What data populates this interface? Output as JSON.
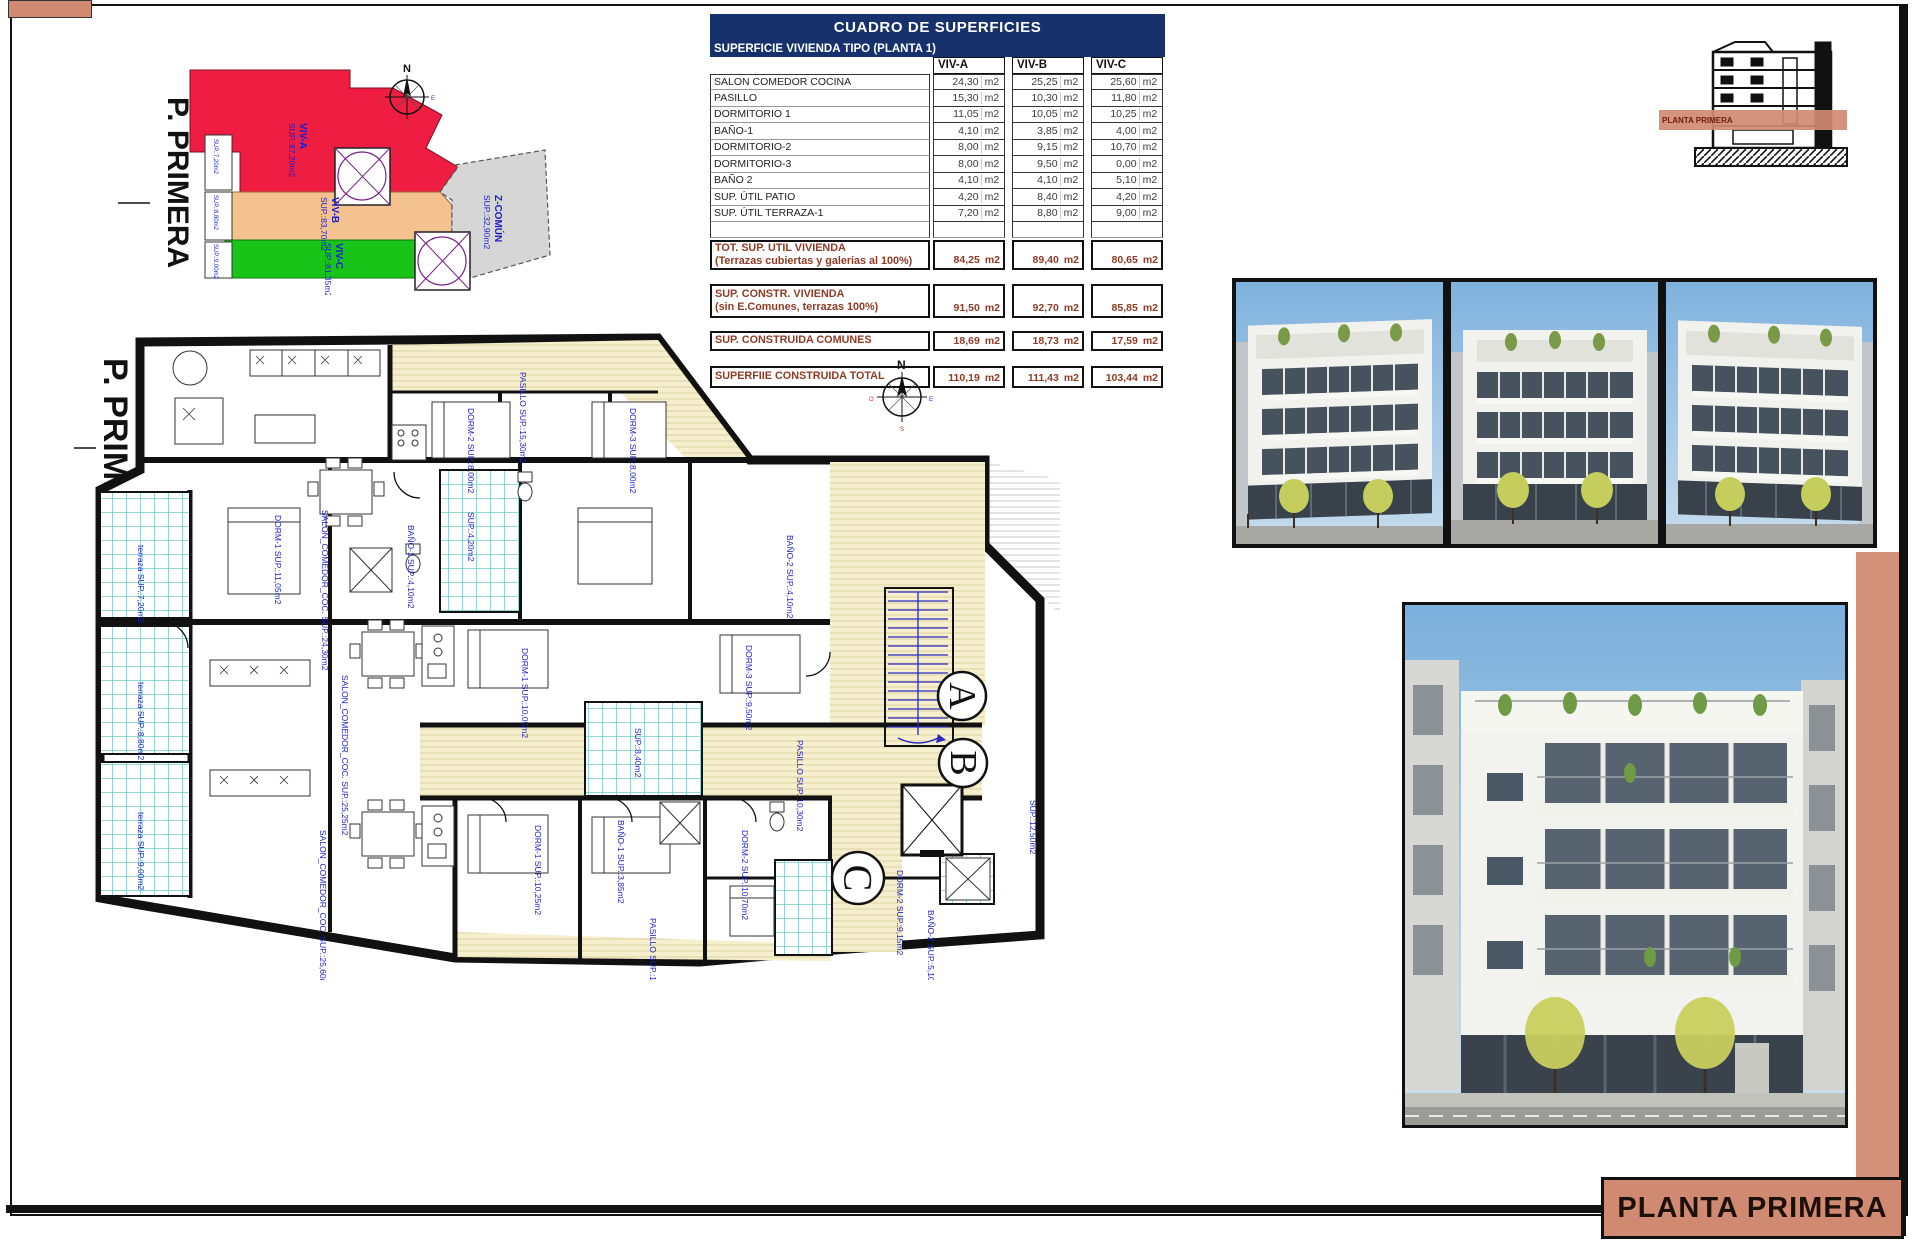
{
  "sheet": {
    "title_block": "PLANTA PRIMERA"
  },
  "colors": {
    "accent_salmon": "#d08a72",
    "navy_header": "#16316b",
    "viv_a_red": "#ee1d41",
    "viv_b_orange": "#f4c28f",
    "viv_c_green": "#17c417",
    "common_gray": "#d6d6d6",
    "label_blue": "#1c1ccf",
    "summary_brown": "#8e3b25"
  },
  "table": {
    "title": "CUADRO DE SUPERFICIES",
    "subtitle": "SUPERFICIE VIVIENDA TIPO  (PLANTA 1)",
    "columns": [
      "VIV-A",
      "VIV-B",
      "VIV-C"
    ],
    "unit": "m2",
    "rows": [
      {
        "label": "SALON COMEDOR COCINA",
        "a": "24,30",
        "b": "25,25",
        "c": "25,60"
      },
      {
        "label": "PASILLO",
        "a": "15,30",
        "b": "10,30",
        "c": "11,80"
      },
      {
        "label": "DORMITORIO 1",
        "a": "11,05",
        "b": "10,05",
        "c": "10,25"
      },
      {
        "label": "BAÑO-1",
        "a": "4,10",
        "b": "3,85",
        "c": "4,00"
      },
      {
        "label": "DORMITORIO-2",
        "a": "8,00",
        "b": "9,15",
        "c": "10,70"
      },
      {
        "label": "DORMITORIO-3",
        "a": "8,00",
        "b": "9,50",
        "c": "0,00"
      },
      {
        "label": "BAÑO 2",
        "a": "4,10",
        "b": "4,10",
        "c": "5,10"
      },
      {
        "label": "SUP. ÚTIL PATIO",
        "a": "4,20",
        "b": "8,40",
        "c": "4,20"
      },
      {
        "label": "SUP. ÚTIL TERRAZA-1",
        "a": "7,20",
        "b": "8,80",
        "c": "9,00"
      }
    ],
    "summary": [
      {
        "label1": "TOT. SUP. UTIL VIVIENDA",
        "label2": "(Terrazas cubiertas y galerias al 100%)",
        "a": "84,25",
        "b": "89,40",
        "c": "80,65"
      },
      {
        "label1": "SUP. CONSTR. VIVIENDA",
        "label2": "(sin E.Comunes, terrazas 100%)",
        "a": "91,50",
        "b": "92,70",
        "c": "85,85"
      },
      {
        "label1": "SUP. CONSTRUIDA COMUNES",
        "label2": "",
        "a": "18,69",
        "b": "18,73",
        "c": "17,59"
      },
      {
        "label1": "SUPERFIIE CONSTRUIDA TOTAL",
        "label2": "",
        "a": "110,19",
        "b": "111,43",
        "c": "103,44"
      }
    ]
  },
  "key_plan": {
    "floor_label": "P. PRIMERA",
    "zones": {
      "viv_a": {
        "name": "VIV-A",
        "sup": "SUP.:87,20m2"
      },
      "viv_b": {
        "name": "VIV-B",
        "sup": "SUP.:83,70m2"
      },
      "viv_c": {
        "name": "VIV-C",
        "sup": "SUP.:81,35m2"
      },
      "comun": {
        "name": "Z-COMÚN",
        "sup": "SUP.:32,90m2"
      }
    },
    "strips": [
      "SUP.:7,20m2",
      "SUP.:8,80m2",
      "SUP.:9,00m2"
    ],
    "compass": {
      "n": "N",
      "s": "S",
      "e": "E",
      "o": "O"
    }
  },
  "section": {
    "band_label": "PLANTA PRIMERA"
  },
  "plan": {
    "floor_label": "P. PRIMERA",
    "compass": {
      "n": "N",
      "s": "S",
      "e": "E",
      "o": "O"
    },
    "stair_letters": [
      "A",
      "B",
      "C"
    ],
    "labels": [
      "SALON_COMEDOR_COC. SUP.:24,30m2",
      "PASILLO SUP.:15,30m2",
      "DORM-2 SUP.:8,00m2",
      "DORM-3 SUP.:8,00m2",
      "DORM-1 SUP.:11,05m2",
      "BAÑO-1 SUP.:4,10m2",
      "BAÑO-2 SUP.:4,10m2",
      "DORM-3 SUP.:9,50m2",
      "PASILLO SUP.:10,30m2",
      "DORM-2 SUP.:9,15m2",
      "SUP.:12,50m2",
      "terraza SUP.:7,20m2",
      "terraza SUP.:8,80m2",
      "terraza SUP.:9,00m2",
      "SALON_COMEDOR_COC. SUP.:25,25m2",
      "SALON_COMEDOR_COC. SUP.:25,60m2",
      "DORM-1 SUP.:10,05m2",
      "DORM-1 SUP.:10,25m2",
      "DORM-2 SUP.:10,70m2",
      "BAÑO-1 SUP.:3,85m2",
      "BAÑO-2 SUP.:5,10m2",
      "PASILLO SUP.:11,80m2",
      "SUP.:4,20m2",
      "SUP.:8,40m2"
    ]
  }
}
